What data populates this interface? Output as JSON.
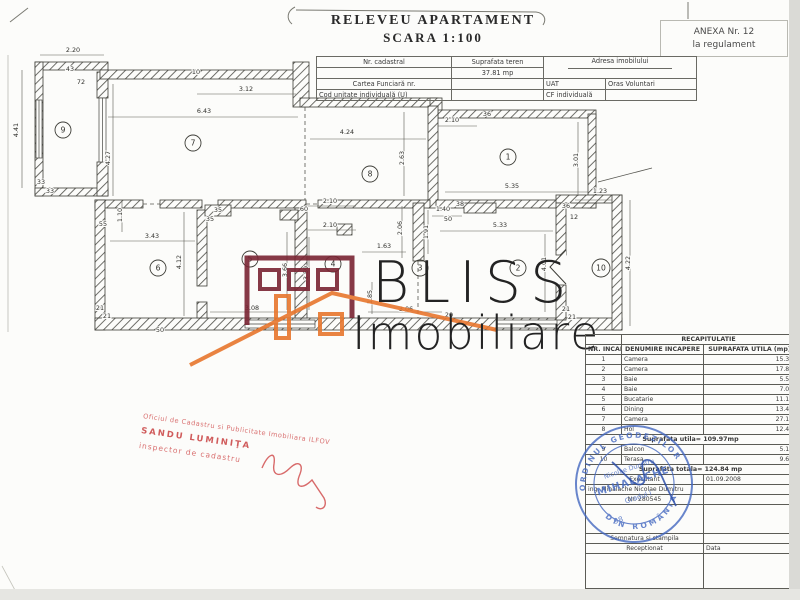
{
  "title": {
    "line1": "RELEVEU APARTAMENT",
    "line2": "SCARA 1:100"
  },
  "anexa": {
    "line1": "ANEXA Nr. 12",
    "line2": "la regulament"
  },
  "header_table": {
    "nr_cadastral_label": "Nr. cadastral",
    "suprafata_teren_label": "Suprafata teren",
    "suprafata_teren_value": "37.81 mp",
    "adresa_label": "Adresa imobilului",
    "cartea_funciara_label": "Cartea Funciară nr.",
    "uat_label": "UAT",
    "uat_value": "Oras Voluntari",
    "cod_unitate_label": "Cod unitate individuală (U)",
    "cf_label": "CF individuală"
  },
  "plan": {
    "rooms": [
      {
        "n": "9",
        "x": 63,
        "y": 130
      },
      {
        "n": "7",
        "x": 193,
        "y": 143
      },
      {
        "n": "8",
        "x": 370,
        "y": 174
      },
      {
        "n": "1",
        "x": 508,
        "y": 157
      },
      {
        "n": "2",
        "x": 518,
        "y": 268
      },
      {
        "n": "10",
        "x": 601,
        "y": 268
      },
      {
        "n": "6",
        "x": 158,
        "y": 268
      },
      {
        "n": "5",
        "x": 250,
        "y": 259
      },
      {
        "n": "4",
        "x": 333,
        "y": 264
      },
      {
        "n": "3",
        "x": 420,
        "y": 268
      }
    ],
    "dims": [
      {
        "t": "2.20",
        "x": 73,
        "y": 52
      },
      {
        "t": "4.41",
        "x": 18,
        "y": 130,
        "v": 1
      },
      {
        "t": "43",
        "x": 70,
        "y": 71
      },
      {
        "t": "72",
        "x": 81,
        "y": 84
      },
      {
        "t": "10",
        "x": 196,
        "y": 74
      },
      {
        "t": "3.12",
        "x": 246,
        "y": 91
      },
      {
        "t": "6.43",
        "x": 204,
        "y": 113
      },
      {
        "t": "4.27",
        "x": 110,
        "y": 158,
        "v": 1
      },
      {
        "t": "33",
        "x": 41,
        "y": 184
      },
      {
        "t": "33",
        "x": 50,
        "y": 193
      },
      {
        "t": "55",
        "x": 103,
        "y": 226
      },
      {
        "t": "1.10",
        "x": 122,
        "y": 215,
        "v": 1
      },
      {
        "t": "3.43",
        "x": 152,
        "y": 238
      },
      {
        "t": "4.12",
        "x": 181,
        "y": 262,
        "v": 1
      },
      {
        "t": "21",
        "x": 100,
        "y": 310
      },
      {
        "t": "21",
        "x": 107,
        "y": 318
      },
      {
        "t": "4.24",
        "x": 347,
        "y": 134
      },
      {
        "t": "2.63",
        "x": 404,
        "y": 158,
        "v": 1
      },
      {
        "t": "2.10",
        "x": 452,
        "y": 122
      },
      {
        "t": "36",
        "x": 487,
        "y": 116
      },
      {
        "t": "3.01",
        "x": 578,
        "y": 160,
        "v": 1
      },
      {
        "t": "5.35",
        "x": 512,
        "y": 188
      },
      {
        "t": "1.23",
        "x": 600,
        "y": 193
      },
      {
        "t": "36",
        "x": 566,
        "y": 208
      },
      {
        "t": "12",
        "x": 574,
        "y": 219
      },
      {
        "t": "1.40",
        "x": 443,
        "y": 211
      },
      {
        "t": "38",
        "x": 460,
        "y": 206
      },
      {
        "t": "50",
        "x": 448,
        "y": 221
      },
      {
        "t": "5.33",
        "x": 500,
        "y": 227
      },
      {
        "t": "2.06",
        "x": 402,
        "y": 228,
        "v": 1
      },
      {
        "t": "1.91",
        "x": 428,
        "y": 232,
        "v": 1
      },
      {
        "t": "4.01",
        "x": 546,
        "y": 264,
        "v": 1
      },
      {
        "t": "4.22",
        "x": 630,
        "y": 263,
        "v": 1
      },
      {
        "t": "2.10",
        "x": 330,
        "y": 203
      },
      {
        "t": "60",
        "x": 304,
        "y": 211
      },
      {
        "t": "2.10",
        "x": 330,
        "y": 227
      },
      {
        "t": "35",
        "x": 218,
        "y": 212
      },
      {
        "t": "35",
        "x": 210,
        "y": 221
      },
      {
        "t": "3.66",
        "x": 287,
        "y": 270,
        "v": 1
      },
      {
        "t": "3.59",
        "x": 308,
        "y": 273,
        "v": 1
      },
      {
        "t": "3.08",
        "x": 252,
        "y": 310
      },
      {
        "t": "1.63",
        "x": 384,
        "y": 248
      },
      {
        "t": "1.85",
        "x": 372,
        "y": 297,
        "v": 1
      },
      {
        "t": "3.06",
        "x": 406,
        "y": 311
      },
      {
        "t": "20",
        "x": 449,
        "y": 317
      },
      {
        "t": "21",
        "x": 566,
        "y": 311
      },
      {
        "t": "21",
        "x": 572,
        "y": 319
      },
      {
        "t": "50",
        "x": 160,
        "y": 332
      }
    ]
  },
  "watermark": {
    "line1": "BLISS",
    "line2": "Imobiliare"
  },
  "red_stamp": {
    "line1": "Oficiul de Cadastru si Publicitate Imobiliara ILFOV",
    "line2": "SANDU LUMINIŢA",
    "line3": "inspector de cadastru"
  },
  "blue_stamp": {
    "ring_top": "ORDINUL GEODEZILOR",
    "ring_bottom": "DIN ROMÂNIA",
    "line1": "Nicolae Dumitru",
    "name": "MIHALACHE",
    "grade": "Gradul I",
    "number": "98"
  },
  "recap_table": {
    "title": "RECAPITULATIE",
    "col1": "NR. INCAPERE",
    "col2": "DENUMIRE INCAPERE",
    "col3": "SUPRAFATA UTILA (mp)",
    "rows": [
      [
        "1",
        "Camera",
        "15.35"
      ],
      [
        "2",
        "Camera",
        "17.80"
      ],
      [
        "3",
        "Baie",
        "5.57"
      ],
      [
        "4",
        "Baie",
        "7.08"
      ],
      [
        "5",
        "Bucatarie",
        "11.15"
      ],
      [
        "6",
        "Dining",
        "13.48"
      ],
      [
        "7",
        "Camera",
        "27.13"
      ],
      [
        "8",
        "Hol",
        "12.41"
      ]
    ],
    "subtotal": "Suprafata utila= 109.97mp",
    "rows2": [
      [
        "9",
        "Balcon",
        "5.19"
      ],
      [
        "10",
        "Terasa",
        "9.68"
      ]
    ],
    "total": "Suprafata totala= 124.84 mp",
    "executant_label": "Executant",
    "executant_date": "01.09.2008",
    "executant_name": "ing. Mihalache Nicolae Dumitru",
    "executant_nr": "Nr. 280545",
    "semnatura1": "Semnatura si stampila",
    "receptionat_label": "Receptionat",
    "data_label": "Data",
    "semnatura2": "Semnătura şi ştampila"
  }
}
